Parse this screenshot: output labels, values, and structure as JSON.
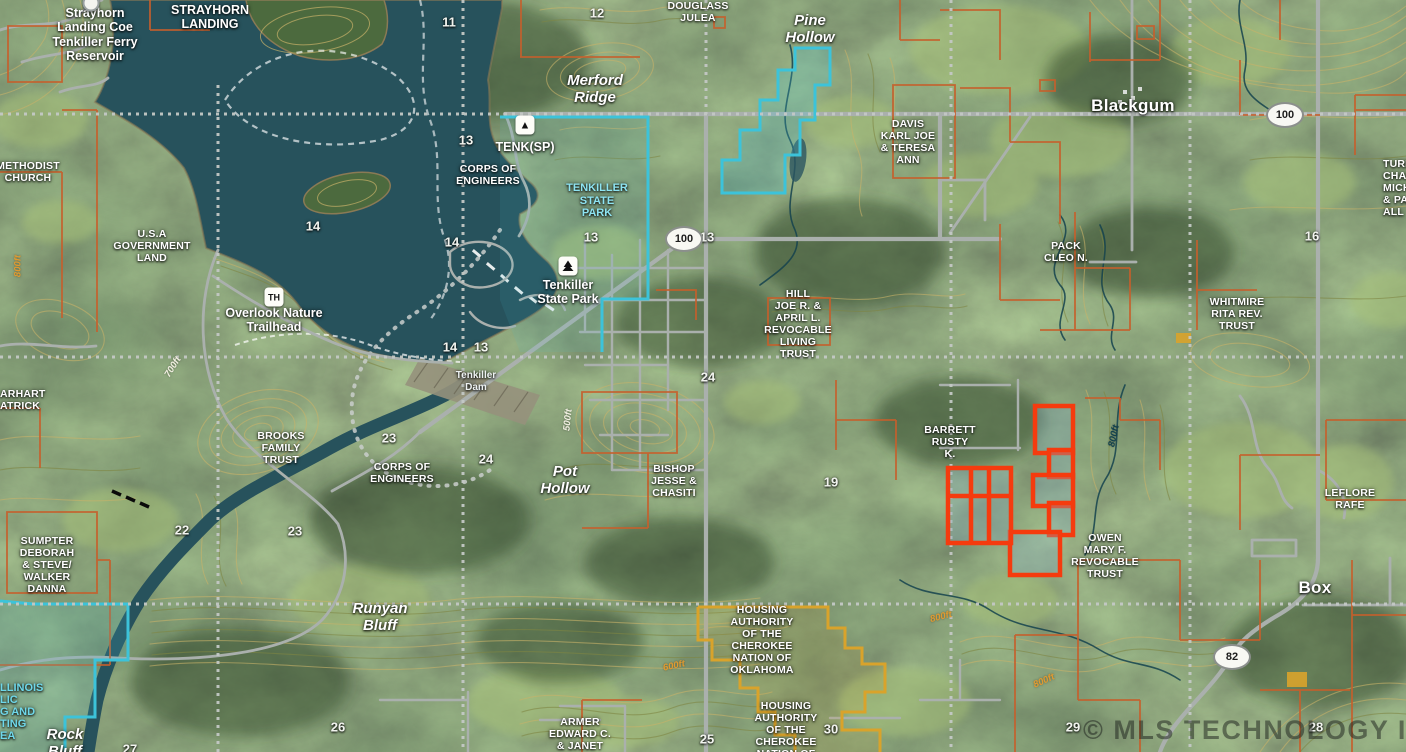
{
  "map": {
    "attribution": "© MLS TECHNOLOGY INC 2025",
    "colors": {
      "water": "#27525c",
      "land": "#4b683d",
      "contour": "#c9b269",
      "contour_olive": "#7f8643",
      "parcel_line": "#c6602c",
      "boundary_cyan": "#3cc3da",
      "highlight_red": "#f53b0e",
      "housing_gold": "#d9a32b",
      "road": "#aab0ad",
      "section_line": "#c3c8c5",
      "label_white": "#ffffff",
      "park_label_cyan": "#8ee4f2",
      "contour_label_orange": "#e09a30",
      "watermark": "rgba(25,30,26,0.5)"
    },
    "labels": [
      {
        "name": "reservoir-label",
        "cls": "big",
        "x": 95,
        "y": 6,
        "text": "Strayhorn\nLanding Coe\nTenkiller Ferry\nReservoir"
      },
      {
        "name": "strayhorn-landing-label",
        "cls": "big",
        "x": 210,
        "y": 3,
        "text": "STRAYHORN\nLANDING"
      },
      {
        "name": "methodist-church-label",
        "cls": "owner",
        "x": 28,
        "y": 160,
        "text": "METHODIST\nCHURCH"
      },
      {
        "name": "usa-government-land-label",
        "cls": "owner",
        "x": 152,
        "y": 228,
        "text": "U.S.A\nGOVERNMENT\nLAND"
      },
      {
        "name": "douglass-julea-label",
        "cls": "owner",
        "x": 698,
        "y": 0,
        "text": "DOUGLASS\nJULEA"
      },
      {
        "name": "merford-ridge-label",
        "cls": "place",
        "x": 595,
        "y": 72,
        "text": "Merford\nRidge"
      },
      {
        "name": "pine-hollow-label",
        "cls": "place",
        "x": 810,
        "y": 12,
        "text": "Pine\nHollow"
      },
      {
        "name": "blackgum-label",
        "cls": "town",
        "x": 1133,
        "y": 96,
        "text": "Blackgum"
      },
      {
        "name": "davis-label",
        "cls": "owner",
        "x": 908,
        "y": 118,
        "text": "DAVIS\nKARL JOE\n& TERESA\nANN"
      },
      {
        "name": "tenk-sp-label",
        "cls": "big",
        "x": 525,
        "y": 140,
        "text": "TENK(SP)"
      },
      {
        "name": "corps-engineers-north-label",
        "cls": "owner",
        "x": 488,
        "y": 163,
        "text": "CORPS OF\nENGINEERS"
      },
      {
        "name": "tenkiller-state-park-cyan-label",
        "cls": "cyanl",
        "x": 597,
        "y": 182,
        "text": "TENKILLER\nSTATE\nPARK"
      },
      {
        "name": "tenkiller-state-park-label",
        "cls": "big",
        "x": 568,
        "y": 278,
        "text": "Tenkiller\nState Park"
      },
      {
        "name": "overlook-trailhead-label",
        "cls": "big",
        "x": 274,
        "y": 306,
        "text": "Overlook Nature\nTrailhead"
      },
      {
        "name": "pack-cleo-label",
        "cls": "owner",
        "x": 1066,
        "y": 240,
        "text": "PACK\nCLEO N."
      },
      {
        "name": "whitmire-label",
        "cls": "owner",
        "x": 1237,
        "y": 296,
        "text": "WHITMIRE\nRITA REV.\nTRUST"
      },
      {
        "name": "turner-label",
        "cls": "owner leftcut",
        "x": 1383,
        "y": 158,
        "text": "TURN\nCHAR\nMICH\n& PAT\nALL"
      },
      {
        "name": "hill-trust-label",
        "cls": "owner",
        "x": 798,
        "y": 288,
        "text": "HILL\nJOE R. &\nAPRIL L.\nREVOCABLE\nLIVING\nTRUST"
      },
      {
        "name": "tenkiller-dam-label",
        "cls": "smalll",
        "x": 476,
        "y": 370,
        "text": "Tenkiller\nDam"
      },
      {
        "name": "earhart-label",
        "cls": "owner leftcut",
        "x": 0,
        "y": 388,
        "text": "ARHART\nATRICK"
      },
      {
        "name": "brooks-label",
        "cls": "owner",
        "x": 281,
        "y": 430,
        "text": "BROOKS\nFAMILY\nTRUST"
      },
      {
        "name": "corps-engineers-south-label",
        "cls": "owner",
        "x": 402,
        "y": 461,
        "text": "CORPS OF\nENGINEERS"
      },
      {
        "name": "pot-hollow-label",
        "cls": "place",
        "x": 565,
        "y": 463,
        "text": "Pot\nHollow"
      },
      {
        "name": "bishop-label",
        "cls": "owner",
        "x": 674,
        "y": 463,
        "text": "BISHOP\nJESSE &\nCHASITI"
      },
      {
        "name": "barrett-label",
        "cls": "owner",
        "x": 950,
        "y": 424,
        "text": "BARRETT\nRUSTY\nK."
      },
      {
        "name": "leflore-label",
        "cls": "owner",
        "x": 1350,
        "y": 487,
        "text": "LEFLORE\nRAFE"
      },
      {
        "name": "owen-label",
        "cls": "owner",
        "x": 1105,
        "y": 532,
        "text": "OWEN\nMARY F.\nREVOCABLE\nTRUST"
      },
      {
        "name": "sumpter-label",
        "cls": "owner",
        "x": 47,
        "y": 535,
        "text": "SUMPTER\nDEBORAH\n& STEVE/\nWALKER\nDANNA"
      },
      {
        "name": "runyan-bluff-label",
        "cls": "place",
        "x": 380,
        "y": 600,
        "text": "Runyan\nBluff"
      },
      {
        "name": "housing-authority-1-label",
        "cls": "owner",
        "x": 762,
        "y": 604,
        "text": "HOUSING\nAUTHORITY\nOF THE\nCHEROKEE\nNATION OF\nOKLAHOMA"
      },
      {
        "name": "housing-authority-2-label",
        "cls": "owner",
        "x": 786,
        "y": 700,
        "text": "HOUSING\nAUTHORITY\nOF THE\nCHEROKEE\nNATION OF\nOKLAHOMA"
      },
      {
        "name": "armer-label",
        "cls": "owner",
        "x": 580,
        "y": 716,
        "text": "ARMER\nEDWARD C.\n& JANET"
      },
      {
        "name": "rock-bluff-label",
        "cls": "place",
        "x": 65,
        "y": 726,
        "text": "Rock\nBluff"
      },
      {
        "name": "box-label",
        "cls": "town",
        "x": 1315,
        "y": 578,
        "text": "Box"
      },
      {
        "name": "illinois-area-label",
        "cls": "frag",
        "x": 0,
        "y": 682,
        "text": "LLINOIS\nLIC\nG AND\nTING\nEA"
      }
    ],
    "section_numbers": [
      {
        "n": "11",
        "x": 449,
        "y": 22
      },
      {
        "n": "12",
        "x": 597,
        "y": 13
      },
      {
        "n": "13",
        "x": 466,
        "y": 140
      },
      {
        "n": "14",
        "x": 313,
        "y": 226
      },
      {
        "n": "14",
        "x": 452,
        "y": 242
      },
      {
        "n": "13",
        "x": 591,
        "y": 237
      },
      {
        "n": "13",
        "x": 707,
        "y": 237
      },
      {
        "n": "14",
        "x": 450,
        "y": 347
      },
      {
        "n": "13",
        "x": 481,
        "y": 347
      },
      {
        "n": "24",
        "x": 708,
        "y": 377
      },
      {
        "n": "16",
        "x": 1312,
        "y": 236
      },
      {
        "n": "23",
        "x": 389,
        "y": 438
      },
      {
        "n": "24",
        "x": 486,
        "y": 459
      },
      {
        "n": "19",
        "x": 831,
        "y": 482
      },
      {
        "n": "22",
        "x": 182,
        "y": 530
      },
      {
        "n": "23",
        "x": 295,
        "y": 531
      },
      {
        "n": "26",
        "x": 338,
        "y": 727
      },
      {
        "n": "27",
        "x": 130,
        "y": 749
      },
      {
        "n": "25",
        "x": 707,
        "y": 739
      },
      {
        "n": "30",
        "x": 831,
        "y": 729
      },
      {
        "n": "29",
        "x": 1073,
        "y": 727
      },
      {
        "n": "28",
        "x": 1316,
        "y": 727
      }
    ],
    "highway_shields": [
      {
        "num": "100",
        "x": 684,
        "y": 239
      },
      {
        "num": "100",
        "x": 1285,
        "y": 115
      },
      {
        "num": "82",
        "x": 1232,
        "y": 657
      }
    ],
    "contour_labels": [
      {
        "t": "800ft",
        "x": 18,
        "y": 266,
        "rot": -90,
        "c": "orange"
      },
      {
        "t": "700ft",
        "x": 173,
        "y": 367,
        "rot": -58,
        "c": "white"
      },
      {
        "t": "500ft",
        "x": 568,
        "y": 420,
        "rot": -84,
        "c": "white"
      },
      {
        "t": "800ft",
        "x": 1114,
        "y": 436,
        "rot": -78,
        "c": "dark"
      },
      {
        "t": "800ft",
        "x": 941,
        "y": 617,
        "rot": -14,
        "c": "orange"
      },
      {
        "t": "600ft",
        "x": 674,
        "y": 666,
        "rot": -12,
        "c": "orange"
      },
      {
        "t": "800ft",
        "x": 1044,
        "y": 681,
        "rot": -24,
        "c": "orange"
      }
    ],
    "poi_icons": [
      {
        "name": "campground-icon",
        "kind": "tent",
        "x": 525,
        "y": 125
      },
      {
        "name": "state-park-tree-icon",
        "kind": "tree",
        "x": 568,
        "y": 266
      },
      {
        "name": "trailhead-icon",
        "kind": "th",
        "x": 274,
        "y": 297,
        "text": "TH"
      },
      {
        "name": "landing-marker-dot",
        "kind": "dot",
        "x": 91,
        "y": 3
      }
    ]
  }
}
